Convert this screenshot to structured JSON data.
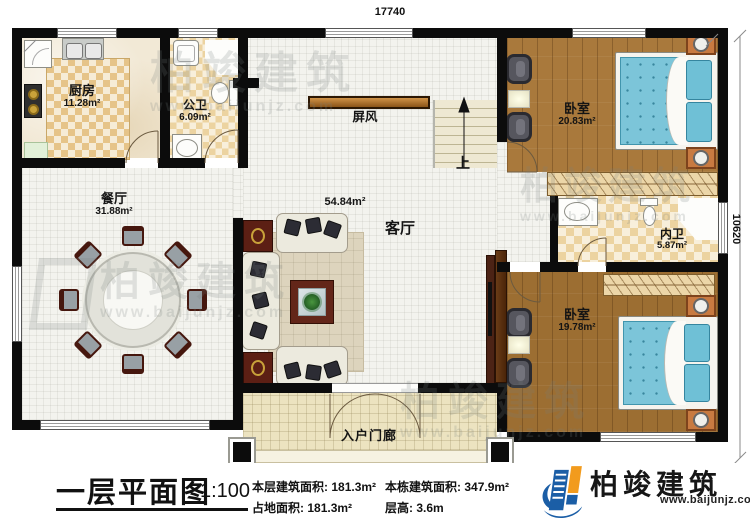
{
  "dimensions": {
    "top": "17740",
    "right": "10620"
  },
  "rooms": {
    "kitchen": {
      "name": "厨房",
      "area": "11.28m²"
    },
    "public_bath": {
      "name": "公卫",
      "area": "6.09m²"
    },
    "dining": {
      "name": "餐厅",
      "area": "31.88m²"
    },
    "living": {
      "name": "客厅",
      "area": "54.84m²"
    },
    "screen": {
      "name": "屏风"
    },
    "stairs": {
      "up": "上"
    },
    "bedroom_top": {
      "name": "卧室",
      "area": "20.83m²"
    },
    "inner_bath": {
      "name": "内卫",
      "area": "5.87m²"
    },
    "bedroom_bottom": {
      "name": "卧室",
      "area": "19.78m²"
    },
    "porch": {
      "name": "入户门廊"
    }
  },
  "title_block": {
    "plan_title": "一层平面图",
    "scale": "1:100",
    "stats": [
      {
        "label": "本层建筑面积:",
        "value": "181.3m²"
      },
      {
        "label": "本栋建筑面积:",
        "value": "347.9m²"
      },
      {
        "label": "占地面积:",
        "value": "181.3m²"
      },
      {
        "label": "层高:",
        "value": "3.6m"
      }
    ]
  },
  "logo": {
    "company": "柏竣建筑",
    "website": "www.baijunjz.com"
  },
  "watermark": {
    "text": "柏竣建筑",
    "website": "www.baijunjz.com"
  },
  "colors": {
    "wall": "#0c0c0c",
    "wood_floor": "#a9793c",
    "tile_tan": "#ecd3a0",
    "bed_blue": "#7cc5d9",
    "logo_blue": "#1b5ea6",
    "logo_orange": "#f29b1d"
  }
}
